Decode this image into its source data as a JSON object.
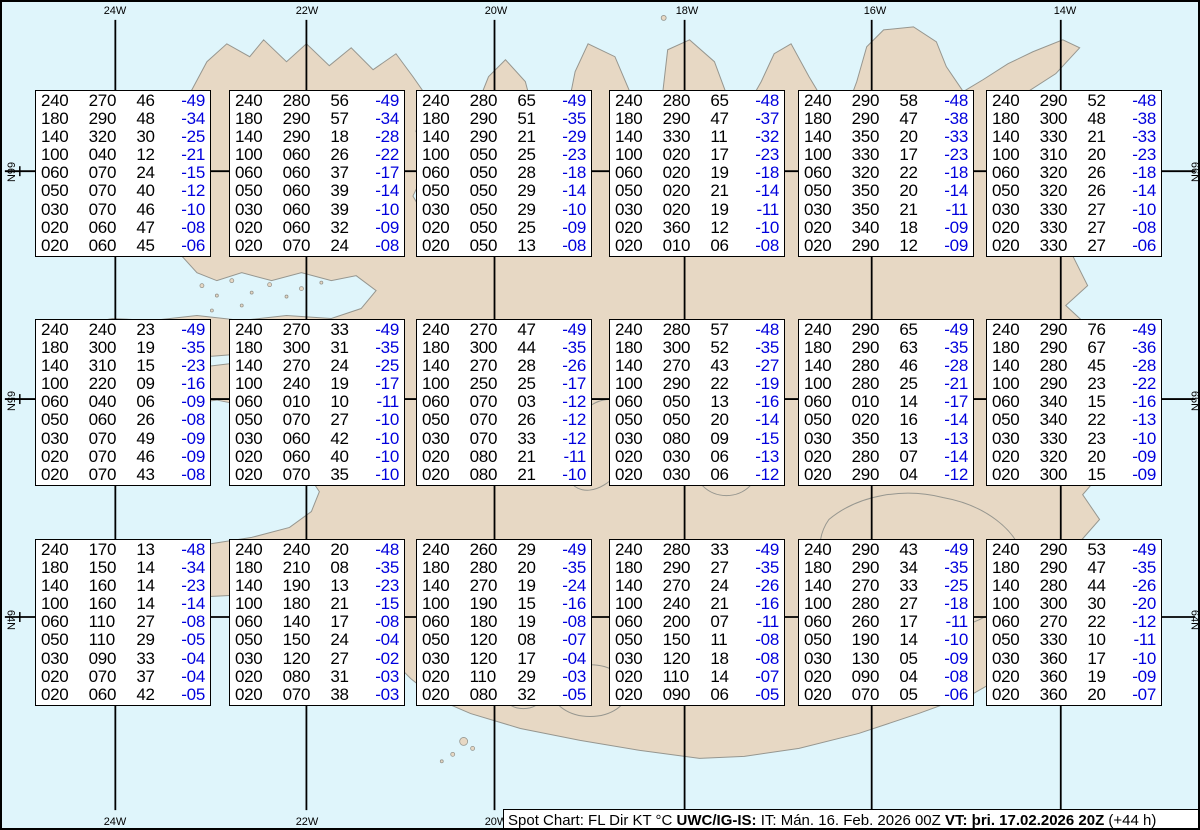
{
  "status_bar": {
    "segments": [
      {
        "text": "Spot Chart: FL Dir KT °C ",
        "bold": false
      },
      {
        "text": "UWC/IG-IS:",
        "bold": true
      },
      {
        "text": " IT: Mán. 16. Feb. 2026 00Z ",
        "bold": false
      },
      {
        "text": "VT: þri. 17.02.2026 20Z",
        "bold": true
      },
      {
        "text": " (+44 h)",
        "bold": false
      }
    ]
  },
  "graticule": {
    "meridians": [
      {
        "label": "24W",
        "x": 113
      },
      {
        "label": "22W",
        "x": 305
      },
      {
        "label": "20W",
        "x": 494
      },
      {
        "label": "18W",
        "x": 685
      },
      {
        "label": "16W",
        "x": 873
      },
      {
        "label": "14W",
        "x": 1063
      }
    ],
    "parallels": [
      {
        "label": "66N",
        "y": 170
      },
      {
        "label": "65N",
        "y": 399
      },
      {
        "label": "64N",
        "y": 618
      }
    ],
    "tick_xs": [
      17,
      208,
      400,
      590,
      780,
      970,
      1158
    ]
  },
  "colors": {
    "ocean": "#dff5fb",
    "land": "#e7d8c4",
    "coastline": "#96968f",
    "graticule": "#000000",
    "box_background": "#ffffff",
    "value_text": "#000000",
    "temperature_text": "#0000dd"
  },
  "column_meanings": [
    "FL",
    "Dir",
    "KT",
    "°C"
  ],
  "spot_boxes": [
    {
      "x": 33,
      "y": 88,
      "rows": [
        [
          "240",
          "270",
          "46",
          "-49"
        ],
        [
          "180",
          "290",
          "48",
          "-34"
        ],
        [
          "140",
          "320",
          "30",
          "-25"
        ],
        [
          "100",
          "040",
          "12",
          "-21"
        ],
        [
          "060",
          "070",
          "24",
          "-15"
        ],
        [
          "050",
          "070",
          "40",
          "-12"
        ],
        [
          "030",
          "070",
          "46",
          "-10"
        ],
        [
          "020",
          "060",
          "47",
          "-08"
        ],
        [
          "020",
          "060",
          "45",
          "-06"
        ]
      ]
    },
    {
      "x": 227,
      "y": 88,
      "rows": [
        [
          "240",
          "280",
          "56",
          "-49"
        ],
        [
          "180",
          "290",
          "57",
          "-34"
        ],
        [
          "140",
          "290",
          "18",
          "-28"
        ],
        [
          "100",
          "060",
          "26",
          "-22"
        ],
        [
          "060",
          "060",
          "37",
          "-17"
        ],
        [
          "050",
          "060",
          "39",
          "-14"
        ],
        [
          "030",
          "060",
          "39",
          "-10"
        ],
        [
          "020",
          "060",
          "32",
          "-09"
        ],
        [
          "020",
          "070",
          "24",
          "-08"
        ]
      ]
    },
    {
      "x": 414,
      "y": 88,
      "rows": [
        [
          "240",
          "280",
          "65",
          "-49"
        ],
        [
          "180",
          "290",
          "51",
          "-35"
        ],
        [
          "140",
          "290",
          "21",
          "-29"
        ],
        [
          "100",
          "050",
          "25",
          "-23"
        ],
        [
          "060",
          "050",
          "28",
          "-18"
        ],
        [
          "050",
          "050",
          "29",
          "-14"
        ],
        [
          "030",
          "050",
          "29",
          "-10"
        ],
        [
          "020",
          "050",
          "25",
          "-09"
        ],
        [
          "020",
          "050",
          "13",
          "-08"
        ]
      ]
    },
    {
      "x": 607,
      "y": 88,
      "rows": [
        [
          "240",
          "280",
          "65",
          "-48"
        ],
        [
          "180",
          "290",
          "47",
          "-37"
        ],
        [
          "140",
          "330",
          "11",
          "-32"
        ],
        [
          "100",
          "020",
          "17",
          "-23"
        ],
        [
          "060",
          "020",
          "19",
          "-18"
        ],
        [
          "050",
          "020",
          "21",
          "-14"
        ],
        [
          "030",
          "020",
          "19",
          "-11"
        ],
        [
          "020",
          "360",
          "12",
          "-10"
        ],
        [
          "020",
          "010",
          "06",
          "-08"
        ]
      ]
    },
    {
      "x": 796,
      "y": 88,
      "rows": [
        [
          "240",
          "290",
          "58",
          "-48"
        ],
        [
          "180",
          "290",
          "47",
          "-38"
        ],
        [
          "140",
          "350",
          "20",
          "-33"
        ],
        [
          "100",
          "330",
          "17",
          "-23"
        ],
        [
          "060",
          "320",
          "22",
          "-18"
        ],
        [
          "050",
          "350",
          "20",
          "-14"
        ],
        [
          "030",
          "350",
          "21",
          "-11"
        ],
        [
          "020",
          "340",
          "18",
          "-09"
        ],
        [
          "020",
          "290",
          "12",
          "-09"
        ]
      ]
    },
    {
      "x": 984,
      "y": 88,
      "rows": [
        [
          "240",
          "290",
          "52",
          "-48"
        ],
        [
          "180",
          "300",
          "48",
          "-38"
        ],
        [
          "140",
          "330",
          "21",
          "-33"
        ],
        [
          "100",
          "310",
          "20",
          "-23"
        ],
        [
          "060",
          "320",
          "26",
          "-18"
        ],
        [
          "050",
          "320",
          "26",
          "-14"
        ],
        [
          "030",
          "330",
          "27",
          "-10"
        ],
        [
          "020",
          "330",
          "27",
          "-08"
        ],
        [
          "020",
          "330",
          "27",
          "-06"
        ]
      ]
    },
    {
      "x": 33,
      "y": 317,
      "rows": [
        [
          "240",
          "240",
          "23",
          "-49"
        ],
        [
          "180",
          "300",
          "19",
          "-35"
        ],
        [
          "140",
          "310",
          "15",
          "-23"
        ],
        [
          "100",
          "220",
          "09",
          "-16"
        ],
        [
          "060",
          "040",
          "06",
          "-09"
        ],
        [
          "050",
          "060",
          "26",
          "-08"
        ],
        [
          "030",
          "070",
          "49",
          "-09"
        ],
        [
          "020",
          "070",
          "46",
          "-09"
        ],
        [
          "020",
          "070",
          "43",
          "-08"
        ]
      ]
    },
    {
      "x": 227,
      "y": 317,
      "rows": [
        [
          "240",
          "270",
          "33",
          "-49"
        ],
        [
          "180",
          "300",
          "31",
          "-35"
        ],
        [
          "140",
          "270",
          "24",
          "-25"
        ],
        [
          "100",
          "240",
          "19",
          "-17"
        ],
        [
          "060",
          "010",
          "10",
          "-11"
        ],
        [
          "050",
          "070",
          "27",
          "-10"
        ],
        [
          "030",
          "060",
          "42",
          "-10"
        ],
        [
          "020",
          "060",
          "40",
          "-10"
        ],
        [
          "020",
          "070",
          "35",
          "-10"
        ]
      ]
    },
    {
      "x": 414,
      "y": 317,
      "rows": [
        [
          "240",
          "270",
          "47",
          "-49"
        ],
        [
          "180",
          "300",
          "44",
          "-35"
        ],
        [
          "140",
          "270",
          "28",
          "-26"
        ],
        [
          "100",
          "250",
          "25",
          "-17"
        ],
        [
          "060",
          "070",
          "03",
          "-12"
        ],
        [
          "050",
          "070",
          "26",
          "-12"
        ],
        [
          "030",
          "070",
          "33",
          "-12"
        ],
        [
          "020",
          "080",
          "21",
          "-11"
        ],
        [
          "020",
          "080",
          "21",
          "-10"
        ]
      ]
    },
    {
      "x": 607,
      "y": 317,
      "rows": [
        [
          "240",
          "280",
          "57",
          "-48"
        ],
        [
          "180",
          "300",
          "52",
          "-35"
        ],
        [
          "140",
          "270",
          "43",
          "-27"
        ],
        [
          "100",
          "290",
          "22",
          "-19"
        ],
        [
          "060",
          "050",
          "13",
          "-16"
        ],
        [
          "050",
          "050",
          "20",
          "-14"
        ],
        [
          "030",
          "080",
          "09",
          "-15"
        ],
        [
          "020",
          "030",
          "06",
          "-13"
        ],
        [
          "020",
          "030",
          "06",
          "-12"
        ]
      ]
    },
    {
      "x": 796,
      "y": 317,
      "rows": [
        [
          "240",
          "290",
          "65",
          "-49"
        ],
        [
          "180",
          "290",
          "63",
          "-35"
        ],
        [
          "140",
          "280",
          "46",
          "-28"
        ],
        [
          "100",
          "280",
          "25",
          "-21"
        ],
        [
          "060",
          "010",
          "14",
          "-17"
        ],
        [
          "050",
          "020",
          "16",
          "-14"
        ],
        [
          "030",
          "350",
          "13",
          "-13"
        ],
        [
          "020",
          "280",
          "07",
          "-14"
        ],
        [
          "020",
          "290",
          "04",
          "-12"
        ]
      ]
    },
    {
      "x": 984,
      "y": 317,
      "rows": [
        [
          "240",
          "290",
          "76",
          "-49"
        ],
        [
          "180",
          "290",
          "67",
          "-36"
        ],
        [
          "140",
          "280",
          "45",
          "-28"
        ],
        [
          "100",
          "290",
          "23",
          "-22"
        ],
        [
          "060",
          "340",
          "15",
          "-16"
        ],
        [
          "050",
          "340",
          "22",
          "-13"
        ],
        [
          "030",
          "330",
          "23",
          "-10"
        ],
        [
          "020",
          "320",
          "20",
          "-09"
        ],
        [
          "020",
          "300",
          "15",
          "-09"
        ]
      ]
    },
    {
      "x": 33,
      "y": 537,
      "rows": [
        [
          "240",
          "170",
          "13",
          "-48"
        ],
        [
          "180",
          "150",
          "14",
          "-34"
        ],
        [
          "140",
          "160",
          "14",
          "-23"
        ],
        [
          "100",
          "160",
          "14",
          "-14"
        ],
        [
          "060",
          "110",
          "27",
          "-08"
        ],
        [
          "050",
          "110",
          "29",
          "-05"
        ],
        [
          "030",
          "090",
          "33",
          "-04"
        ],
        [
          "020",
          "070",
          "37",
          "-04"
        ],
        [
          "020",
          "060",
          "42",
          "-05"
        ]
      ]
    },
    {
      "x": 227,
      "y": 537,
      "rows": [
        [
          "240",
          "240",
          "20",
          "-48"
        ],
        [
          "180",
          "210",
          "08",
          "-35"
        ],
        [
          "140",
          "190",
          "13",
          "-23"
        ],
        [
          "100",
          "180",
          "21",
          "-15"
        ],
        [
          "060",
          "140",
          "17",
          "-08"
        ],
        [
          "050",
          "150",
          "24",
          "-04"
        ],
        [
          "030",
          "120",
          "27",
          "-02"
        ],
        [
          "020",
          "080",
          "31",
          "-03"
        ],
        [
          "020",
          "070",
          "38",
          "-03"
        ]
      ]
    },
    {
      "x": 414,
      "y": 537,
      "rows": [
        [
          "240",
          "260",
          "29",
          "-49"
        ],
        [
          "180",
          "280",
          "20",
          "-35"
        ],
        [
          "140",
          "270",
          "19",
          "-24"
        ],
        [
          "100",
          "190",
          "15",
          "-16"
        ],
        [
          "060",
          "180",
          "19",
          "-08"
        ],
        [
          "050",
          "120",
          "08",
          "-07"
        ],
        [
          "030",
          "120",
          "17",
          "-04"
        ],
        [
          "020",
          "110",
          "29",
          "-03"
        ],
        [
          "020",
          "080",
          "32",
          "-05"
        ]
      ]
    },
    {
      "x": 607,
      "y": 537,
      "rows": [
        [
          "240",
          "280",
          "33",
          "-49"
        ],
        [
          "180",
          "290",
          "27",
          "-35"
        ],
        [
          "140",
          "270",
          "24",
          "-26"
        ],
        [
          "100",
          "240",
          "21",
          "-16"
        ],
        [
          "060",
          "200",
          "07",
          "-11"
        ],
        [
          "050",
          "150",
          "11",
          "-08"
        ],
        [
          "030",
          "120",
          "18",
          "-08"
        ],
        [
          "020",
          "110",
          "14",
          "-07"
        ],
        [
          "020",
          "090",
          "06",
          "-05"
        ]
      ]
    },
    {
      "x": 796,
      "y": 537,
      "rows": [
        [
          "240",
          "290",
          "43",
          "-49"
        ],
        [
          "180",
          "290",
          "34",
          "-35"
        ],
        [
          "140",
          "270",
          "33",
          "-25"
        ],
        [
          "100",
          "280",
          "27",
          "-18"
        ],
        [
          "060",
          "260",
          "17",
          "-11"
        ],
        [
          "050",
          "190",
          "14",
          "-10"
        ],
        [
          "030",
          "130",
          "05",
          "-09"
        ],
        [
          "020",
          "090",
          "04",
          "-08"
        ],
        [
          "020",
          "070",
          "05",
          "-06"
        ]
      ]
    },
    {
      "x": 984,
      "y": 537,
      "rows": [
        [
          "240",
          "290",
          "53",
          "-49"
        ],
        [
          "180",
          "290",
          "47",
          "-35"
        ],
        [
          "140",
          "280",
          "44",
          "-26"
        ],
        [
          "100",
          "300",
          "30",
          "-20"
        ],
        [
          "060",
          "270",
          "22",
          "-12"
        ],
        [
          "050",
          "330",
          "10",
          "-11"
        ],
        [
          "030",
          "360",
          "17",
          "-10"
        ],
        [
          "020",
          "360",
          "19",
          "-09"
        ],
        [
          "020",
          "360",
          "20",
          "-07"
        ]
      ]
    }
  ]
}
